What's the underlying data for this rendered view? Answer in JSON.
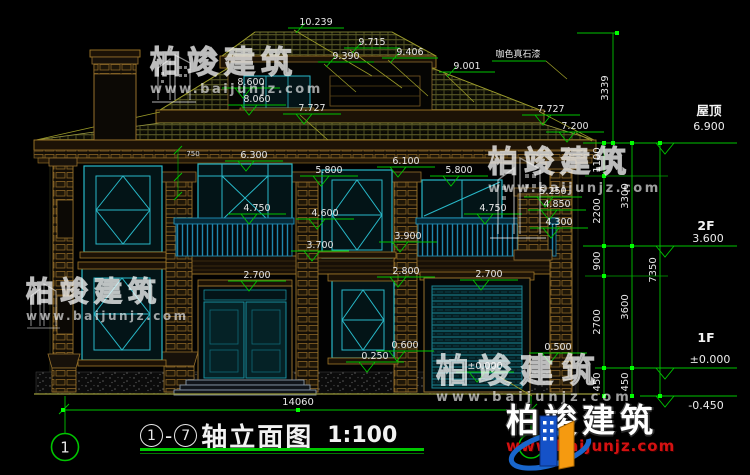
{
  "drawing": {
    "title": {
      "axis_start": "1",
      "separator": "-",
      "axis_end": "7",
      "label": "轴立面图",
      "scale": "1:100"
    },
    "material_note": "咖色真石漆",
    "axis_bubble_left": "1",
    "axis_bubble_right": "7"
  },
  "levels": {
    "roof": {
      "label": "屋顶",
      "value": "6.900"
    },
    "f2": {
      "label": "2F",
      "value": "3.600"
    },
    "f1": {
      "label": "1F",
      "value": "±0.000"
    },
    "base": {
      "value": "-0.450"
    }
  },
  "marks": {
    "top": [
      "10.239",
      "9.715",
      "9.390",
      "9.406",
      "9.001"
    ],
    "levels": [
      "8.600",
      "8.060",
      "7.727",
      "7.727",
      "7.200",
      "6.300",
      "6.100",
      "5.800",
      "5.800",
      "5.250",
      "4.850",
      "4.750",
      "4.750",
      "4.600",
      "4.300",
      "3.900",
      "3.700",
      "2.800",
      "2.700",
      "2.700",
      "0.600",
      "0.500",
      "0.250",
      "±0.000"
    ]
  },
  "vdims": {
    "overall_top": "3339",
    "inner": [
      "1100",
      "2200",
      "900",
      "2700",
      "450"
    ],
    "middle": [
      "3300",
      "3600",
      "450"
    ],
    "outer": "7350"
  },
  "hdims": {
    "overall": "14060",
    "small": "750"
  },
  "watermark": {
    "brand": "柏竣建筑",
    "site": "www.baijunjz.com"
  },
  "logo": {
    "brand": "柏竣建筑",
    "site": "www.baijunjz.com"
  }
}
